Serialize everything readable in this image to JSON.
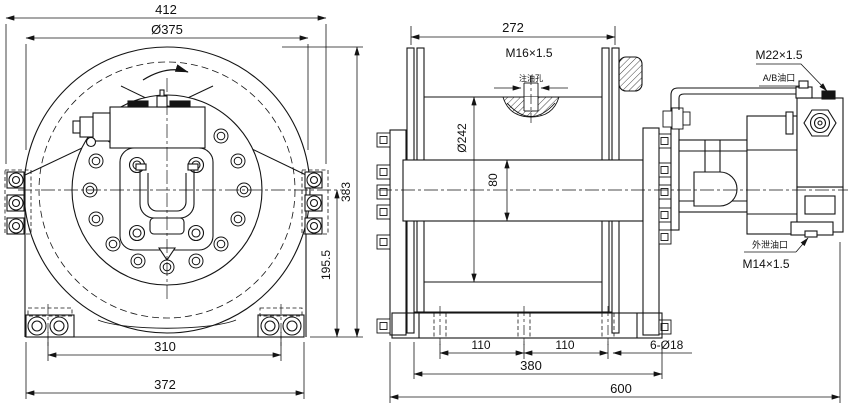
{
  "page": {
    "background": "#ffffff",
    "line_color": "#141414"
  },
  "front_view": {
    "view_name": "winch-front-view",
    "dim_overall_width": "412",
    "dim_flange_diameter": "Ø375",
    "dim_overall_height": "383",
    "dim_axis_height": "195.5",
    "dim_foot_bolt_spacing": "310",
    "dim_base_width": "372"
  },
  "side_view": {
    "view_name": "winch-side-view",
    "dim_drum_length": "272",
    "label_fill_port_thread": "M16×1.5",
    "label_fill_port": "注油孔",
    "dim_flange_diameter": "Ø242",
    "dim_barrel_diameter": "80",
    "dim_hole_pitch_left": "110",
    "dim_hole_pitch_right": "110",
    "label_mount_holes": "6-Ø18",
    "dim_base_length": "380",
    "dim_overall_length": "600",
    "label_ab_port_thread": "M22×1.5",
    "label_ab_port": "A/B油口",
    "label_drain_port": "外泄油口",
    "label_drain_port_thread": "M14×1.5"
  }
}
